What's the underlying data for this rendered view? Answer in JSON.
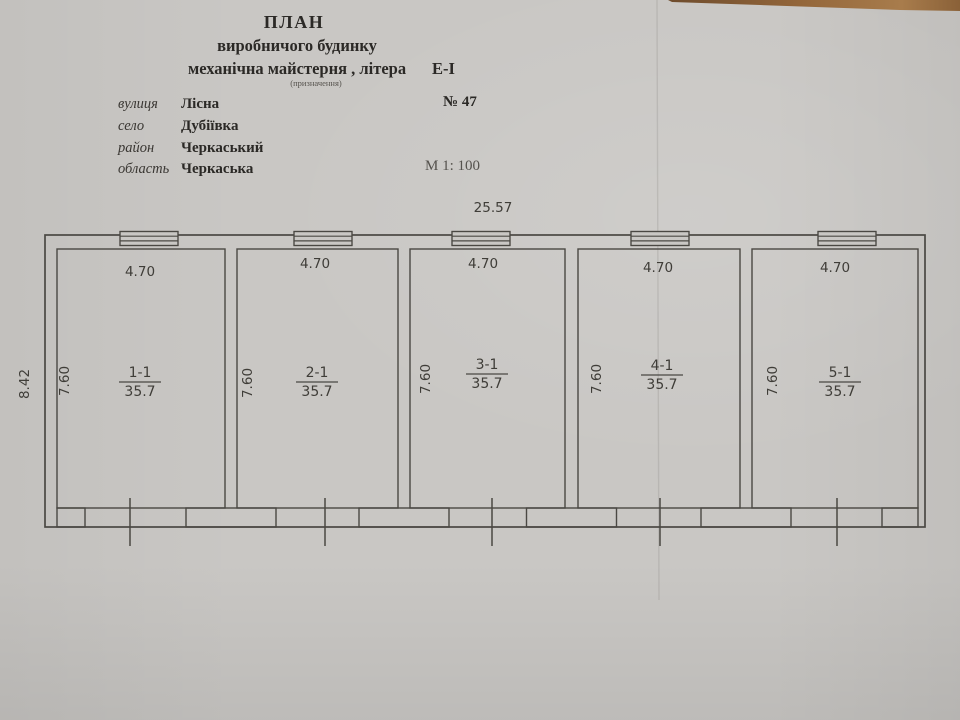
{
  "document": {
    "title_line1": "ПЛАН",
    "title_line2": "виробничого будинку",
    "title_line3a": "механічна майстерня , літера",
    "title_line3b": "Е-І",
    "title_note": "(призначення)",
    "address": {
      "street_label": "вулиця",
      "street_value": "Лісна",
      "building_number": "№ 47",
      "village_label": "село",
      "village_value": "Дубіївка",
      "district_label": "район",
      "district_value": "Черкаський",
      "region_label": "область",
      "region_value": "Черкаська"
    },
    "scale": "М 1: 100"
  },
  "plan": {
    "overall_width_m": "25.57",
    "overall_depth_m": "8.42",
    "rooms": [
      {
        "number": "1-1",
        "area": "35.7",
        "width": "4.70",
        "depth": "7.60"
      },
      {
        "number": "2-1",
        "area": "35.7",
        "width": "4.70",
        "depth": "7.60"
      },
      {
        "number": "3-1",
        "area": "35.7",
        "width": "4.70",
        "depth": "7.60"
      },
      {
        "number": "4-1",
        "area": "35.7",
        "width": "4.70",
        "depth": "7.60"
      },
      {
        "number": "5-1",
        "area": "35.7",
        "width": "4.70",
        "depth": "7.60"
      }
    ]
  }
}
